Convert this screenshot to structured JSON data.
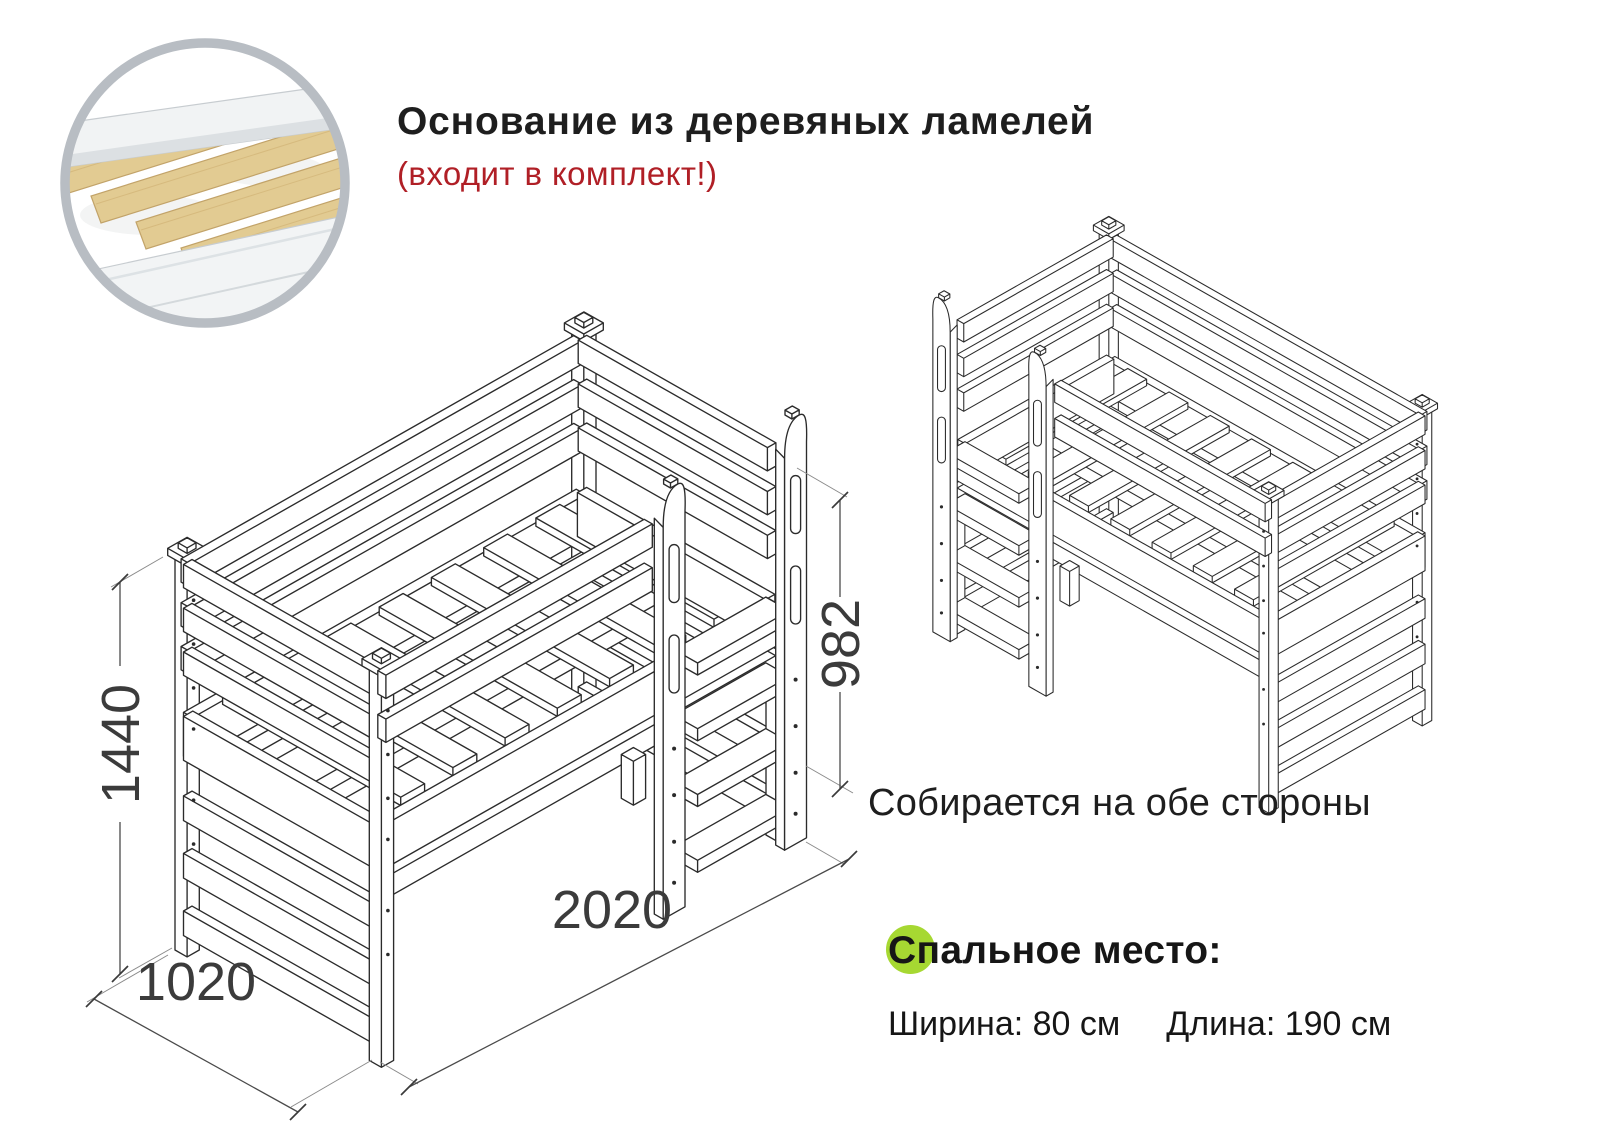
{
  "header": {
    "title": "Основание из деревяных ламелей",
    "subtitle": "(входит в комплект!)"
  },
  "diagram": {
    "caption": "Собирается на обе стороны",
    "dimensions": {
      "height": "1440",
      "width": "1020",
      "length": "2020",
      "ladder_height": "982"
    },
    "units": "мм"
  },
  "sleeping_area": {
    "title": "Спальное место:",
    "width_label": "Ширина: 80 см",
    "length_label": "Длина: 190 см"
  },
  "colors": {
    "accent_red": "#b01f26",
    "accent_green": "#a6d832",
    "line_color": "#2b2b2b",
    "dim_text": "#3b3b3b",
    "slat_wood": "#e2cb92",
    "inset_ring": "#b8bdc3"
  }
}
